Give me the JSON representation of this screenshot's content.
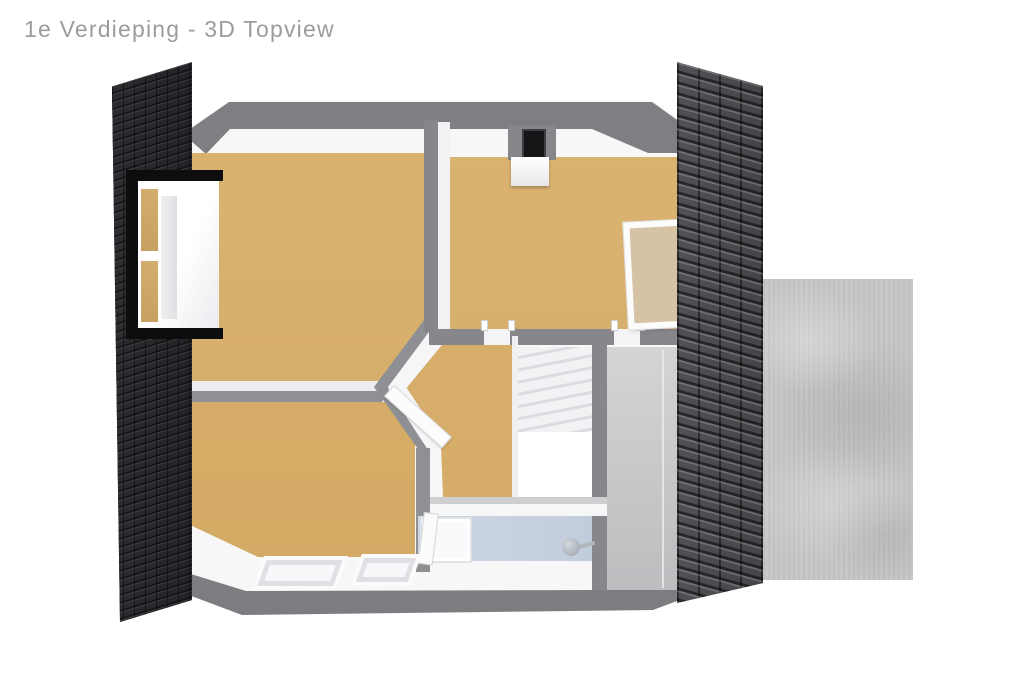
{
  "page": {
    "title": "1e Verdieping - 3D Topview",
    "title_color": "#9c9c9c",
    "background": "#ffffff"
  },
  "palette": {
    "wood_floor": "#d8b06c",
    "wall_top": "#87878b",
    "wall_face": "#ffffff",
    "outline_band": "#828286",
    "roof_left_tiles": "#2a2a2e",
    "roof_right_tiles": "#4b4b4f",
    "concrete_terrace": "#c7c7c8",
    "bathroom_floor": "#c9d3e0",
    "window_frame": "#0d0d0e",
    "roof_window_fill": "#d6c3a5",
    "stair_steps": "#e3e3e7"
  },
  "regions": {
    "rooms": [
      {
        "name": "bedroom-top-left",
        "floor": "wood"
      },
      {
        "name": "bedroom-top-right",
        "floor": "wood"
      },
      {
        "name": "bedroom-bottom-left",
        "floor": "wood"
      },
      {
        "name": "hallway",
        "floor": "wood"
      },
      {
        "name": "bathroom",
        "floor": "blue-tile"
      },
      {
        "name": "stairwell",
        "floor": "white"
      },
      {
        "name": "landing-gray",
        "floor": "gray"
      }
    ],
    "exterior": [
      "roof-left",
      "roof-right",
      "concrete-terrace"
    ]
  },
  "fixtures": [
    "dormer-window",
    "chimney",
    "roof-window",
    "bathtub",
    "shower-head",
    "skylight-1",
    "skylight-2",
    "hallway-door",
    "bathroom-door"
  ]
}
